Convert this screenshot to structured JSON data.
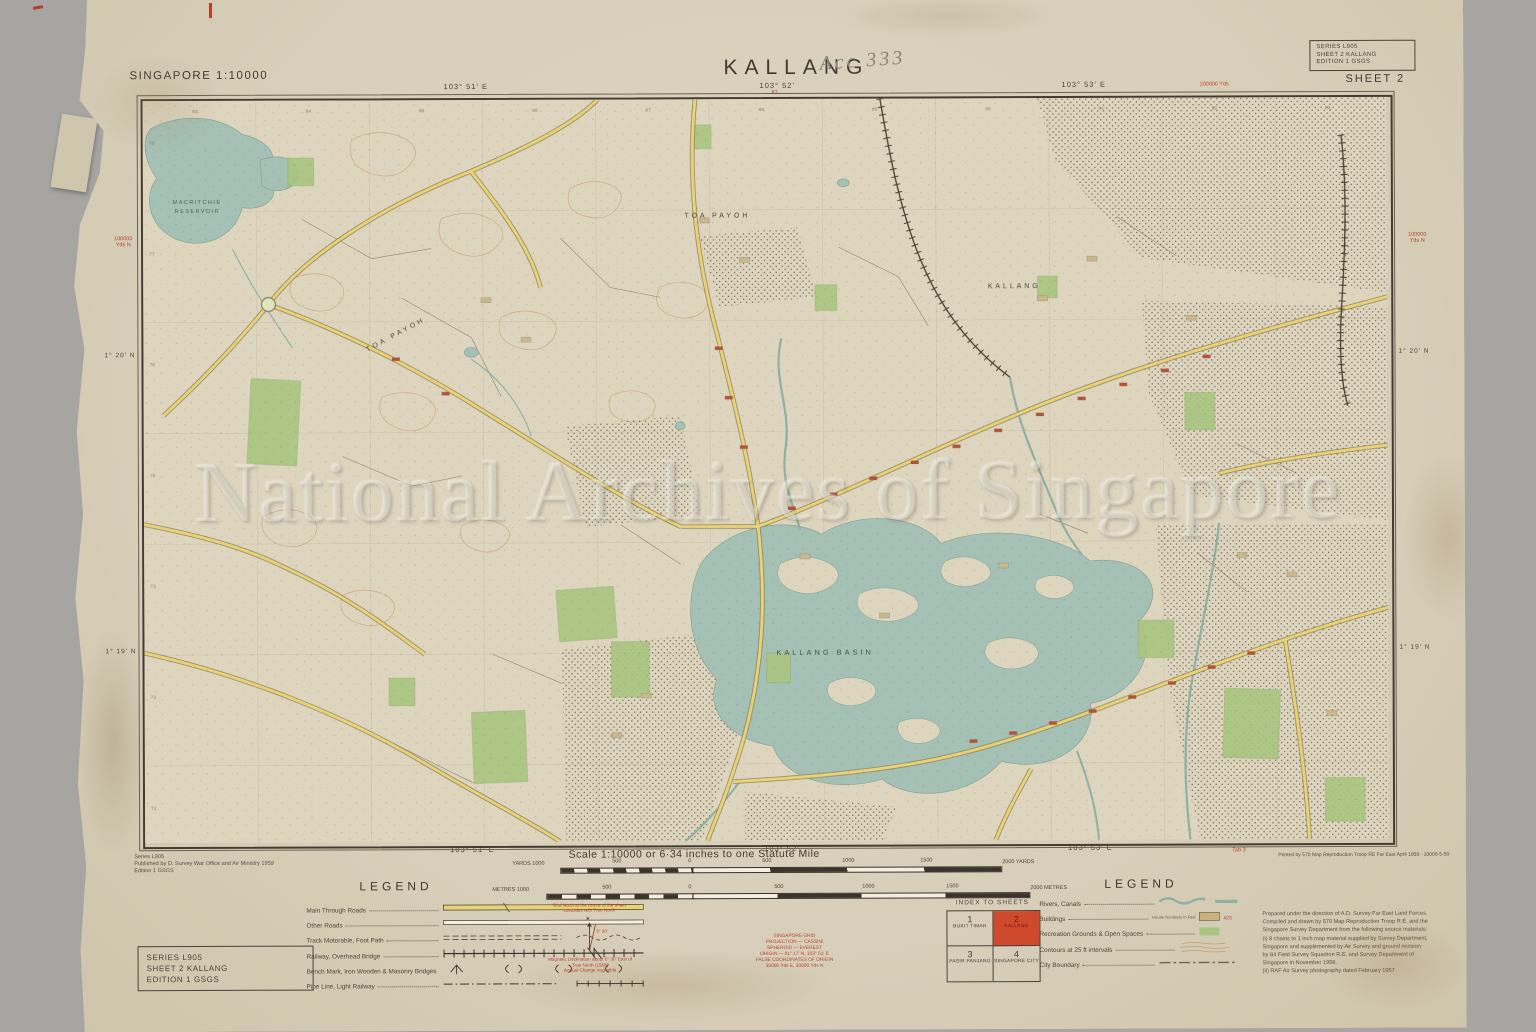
{
  "header": {
    "region_scale": "SINGAPORE 1:10000",
    "title": "KALLANG",
    "handwritten_acc": "Acc 333",
    "sheet_label": "SHEET 2",
    "series_box": {
      "series": "SERIES L905",
      "sheet": "SHEET 2 KALLANG",
      "edition": "EDITION 1 GSGS"
    }
  },
  "map": {
    "watermark": "National Archives of Singapore",
    "labels": {
      "reservoir_line1": "MACRITCHIE",
      "reservoir_line2": "RESERVOIR",
      "toa_payoh": "TOA PAYOH",
      "kallang": "KALLANG",
      "kallang_basin": "KALLANG BASIN"
    },
    "coords": {
      "top_left": "103° 51' E",
      "top_mid": "103° 52'",
      "top_right": "103° 53' E",
      "bottom_left": "103° 51' E",
      "bottom_mid": "103° 52'",
      "bottom_right": "103° 53' E",
      "left_upper": "1° 20' N",
      "left_lower": "1° 19' N",
      "right_upper": "1° 20' N",
      "right_lower": "1° 19' N",
      "red_tick": "87",
      "red_margin_left_1": "100000",
      "red_margin_left_2": "Yds N",
      "red_margin_top_right": "100000 Yds",
      "red_tab": "Tab 3",
      "eastings": [
        "83",
        "84",
        "85",
        "86",
        "87",
        "88",
        "89",
        "90",
        "91",
        "92",
        "93"
      ],
      "northings": [
        "78",
        "77",
        "76",
        "75",
        "74",
        "73",
        "72"
      ]
    }
  },
  "footer": {
    "publisher": [
      "Series L905",
      "Published by D. Survey War Office and Air Ministry 1959",
      "Edition 1 GSGS"
    ],
    "print_note": "Printed by 570 Map Reproduction Troop RE Far East April 1959 · 10000-5-59",
    "scale_title": "Scale 1:10000 or 6·34 inches to one Statute Mile",
    "scalebar_yards": {
      "left_label": "YARDS 1000",
      "ticks": [
        "500",
        "0",
        "500",
        "1000",
        "1500"
      ],
      "right_label": "2000 YARDS"
    },
    "scalebar_metres": {
      "left_label": "METRES 1000",
      "ticks": [
        "500",
        "0",
        "500",
        "1000",
        "1500"
      ],
      "right_label": "2000 METRES"
    },
    "legend_left": {
      "title": "LEGEND",
      "rows": [
        "Main Through Roads",
        "Other Roads",
        "Track Motorable, Foot Path",
        "Railway, Overhead Bridge",
        "Bench Mark, Iron Wooden & Masonry Bridges",
        "Pipe Line, Light Railway"
      ]
    },
    "declination": {
      "note_top_1": "Grid North at the centre of the sheet",
      "note_top_2": "coincides with True North",
      "angle": "0° 30'",
      "note_bottom_1": "Magnetic Declination about 0° 30' East of",
      "note_bottom_2": "True North (1958)",
      "note_bottom_3": "Annual Change negligible"
    },
    "grid_info": [
      "SINGAPORE GRID",
      "PROJECTION — CASSINI",
      "SPHEROID — EVEREST",
      "ORIGIN — 01° 17' N, 103° 51' E",
      "FALSE COORDINATES OF ORIGIN",
      "30000 Yds E, 30000 Yds N"
    ],
    "index_to_sheets": {
      "title": "INDEX TO SHEETS",
      "cells": [
        {
          "num": "1",
          "name": "BUKIT TIMAH"
        },
        {
          "num": "2",
          "name": "KALLANG"
        },
        {
          "num": "3",
          "name": "PASIR PANJANG"
        },
        {
          "num": "4",
          "name": "SINGAPORE CITY"
        }
      ]
    },
    "legend_right": {
      "title": "LEGEND",
      "rows": [
        "Rivers, Canals",
        "Buildings",
        "Recreation Grounds & Open Spaces",
        "Contours at 25 ft intervals",
        "City Boundary"
      ],
      "buildings_note": "House Numbers in Red",
      "building_number": "423"
    },
    "credits": [
      "Prepared under the direction of A.D. Survey Far East Land Forces.",
      "Compiled and drawn by 570 Map Reproduction Troop R.E. and the",
      "Singapore Survey Department from the following source materials:",
      "(i) 8 chains to 1 inch map material supplied by Survey Department,",
      "Singapore and supplemented by Air Survey and ground revision",
      "by 84 Field Survey Squadron R.E. and Survey Department of",
      "Singapore in November 1958.",
      "(ii) RAF Air Survey photography dated February 1957"
    ],
    "series_box": {
      "series": "SERIES L905",
      "sheet": "SHEET 2 KALLANG",
      "edition": "EDITION 1 GSGS"
    }
  },
  "colors": {
    "highlight_red": "#cf4a2d",
    "water_teal": "#a5c0b4",
    "park_green": "#a9c581",
    "road_yellow": "#e6d275",
    "ink_red": "#b5402c"
  }
}
